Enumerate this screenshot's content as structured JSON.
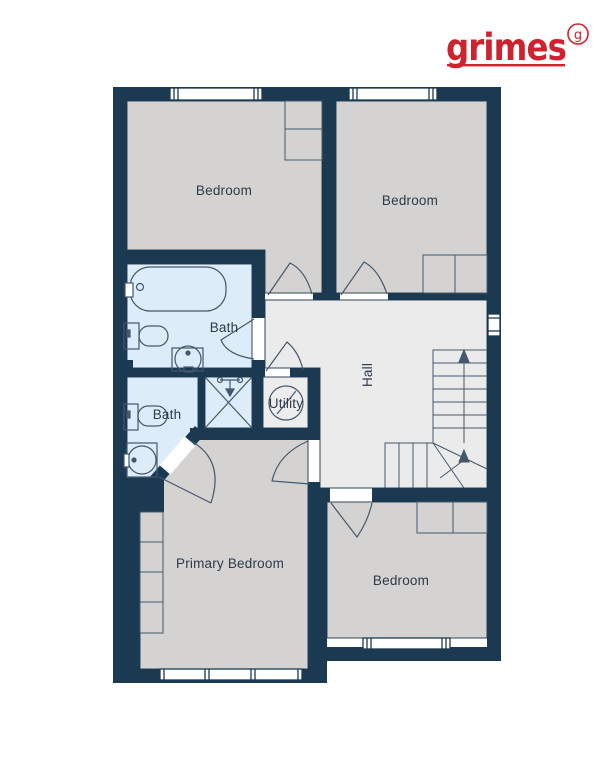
{
  "logo": {
    "text": "grimes",
    "mark": "g",
    "color": "#d0222e"
  },
  "floor_plan": {
    "rooms": [
      {
        "id": "bedroom-1",
        "label": "Bedroom"
      },
      {
        "id": "bedroom-2",
        "label": "Bedroom"
      },
      {
        "id": "bath-1",
        "label": "Bath"
      },
      {
        "id": "bath-2",
        "label": "Bath"
      },
      {
        "id": "utility",
        "label": "Utility"
      },
      {
        "id": "hall",
        "label": "Hall"
      },
      {
        "id": "primary-bedroom",
        "label": "Primary Bedroom"
      },
      {
        "id": "bedroom-3",
        "label": "Bedroom"
      }
    ],
    "colors": {
      "wall": "#1b3a52",
      "bedroom_floor": "#d4d3d1",
      "bath_floor": "#dcedf9",
      "hall_floor": "#ebebeb",
      "utility_floor": "#ededed",
      "floor_outline": "#31465a",
      "fixture_line": "#44586c",
      "label_text": "#2c3a49",
      "window_fill": "#ffffff"
    }
  }
}
